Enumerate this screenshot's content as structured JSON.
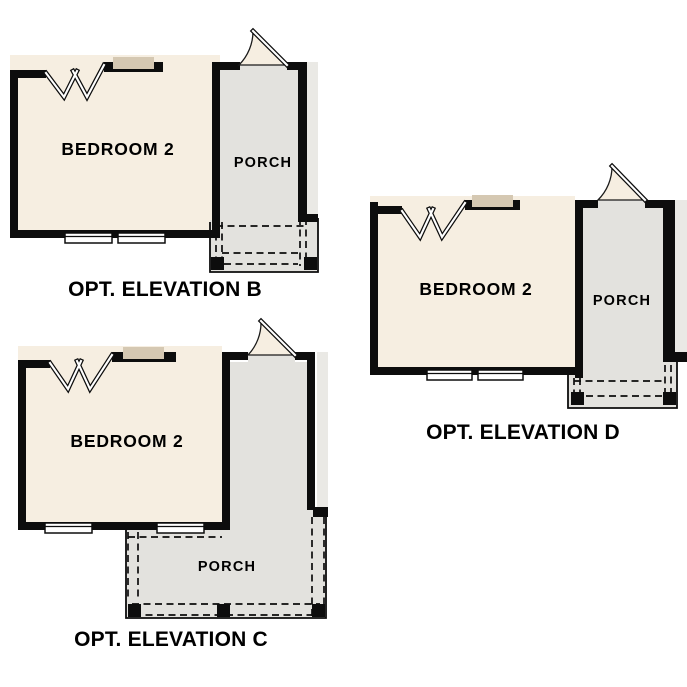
{
  "sheet": {
    "background": "#ffffff"
  },
  "colors": {
    "room_fill": "#f6eee1",
    "porch_fill": "#e3e2de",
    "siding_fill": "#eae9e5",
    "window_tan": "#d5c8b2",
    "wall": "#0d0d0d",
    "label_text": "#000000"
  },
  "plans": [
    {
      "caption": "OPT. ELEVATION B",
      "room_label": "BEDROOM 2",
      "porch_label": "PORCH"
    },
    {
      "caption": "OPT. ELEVATION C",
      "room_label": "BEDROOM 2",
      "porch_label": "PORCH"
    },
    {
      "caption": "OPT. ELEVATION D",
      "room_label": "BEDROOM 2",
      "porch_label": "PORCH"
    }
  ]
}
